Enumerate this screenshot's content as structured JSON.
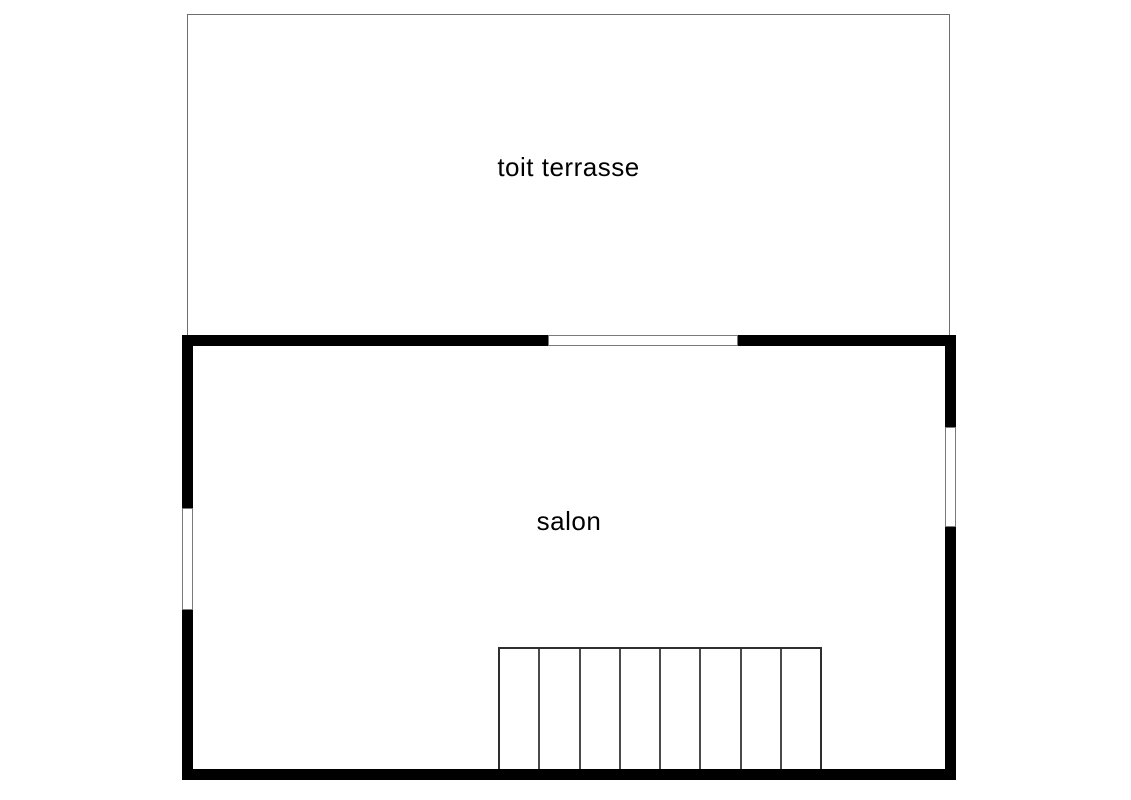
{
  "rooms": {
    "terrace": {
      "label": "toit terrasse"
    },
    "salon": {
      "label": "salon"
    }
  },
  "staircase": {
    "steps": 8
  },
  "openings": {
    "top_wall_window": "window-opening-in-wall-between-salon-and-terrace",
    "left_wall_window": "window-opening-in-left-wall",
    "right_wall_window": "window-opening-in-right-wall"
  },
  "colors": {
    "background": "#ffffff",
    "thick_wall": "#000000",
    "thin_line": "#6e6e6e",
    "stair_line": "#4a4a4a",
    "text": "#000000"
  }
}
